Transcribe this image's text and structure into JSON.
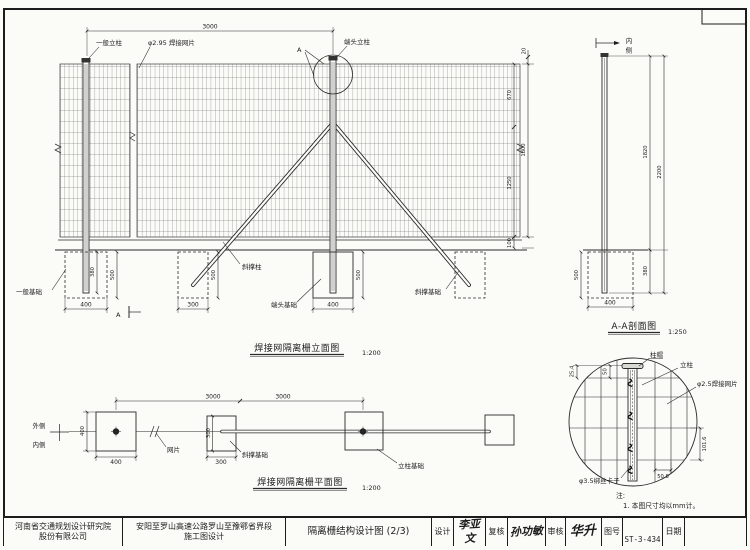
{
  "meta": {
    "paper_color": "#fbfbf8",
    "ink_color": "#1c1c1c"
  },
  "elevation": {
    "title": "焊接网隔离栅立面图",
    "scale": "1:200",
    "span_dim": "3000",
    "general_post_label": "一般立柱",
    "mesh_label": "φ2.95 焊接网片",
    "detail_ref": "A",
    "end_post_label": "端头立柱",
    "brace_post_label": "斜撑柱",
    "general_foundation_label": "一般基础",
    "end_foundation_label": "端头基础",
    "brace_foundation_label": "斜撑基础",
    "section_mark": "A",
    "dims": {
      "cap": "20",
      "upper": "670",
      "total": "1800",
      "lower": "1250",
      "ground_gap": "100",
      "post_embed": "380",
      "found_depth1": "500",
      "found_width1": "400",
      "brace_found_depth": "500",
      "brace_found_width": "300",
      "end_found_width": "400",
      "end_found_depth": "500"
    }
  },
  "section_aa": {
    "title": "A-A剖面图",
    "scale": "1:250",
    "inner_chars": [
      "内",
      "侧"
    ],
    "dims": {
      "above_ground": "1820",
      "total": "2200",
      "embed": "380",
      "found_depth": "500",
      "found_width": "400"
    }
  },
  "plan": {
    "title": "焊接网隔离栅平面图",
    "scale": "1:200",
    "outer_label": "外侧",
    "inner_label": "内侧",
    "mesh_label": "网片",
    "brace_foundation_label": "斜撑基础",
    "post_foundation_label": "立柱基础",
    "dims": {
      "found_h": "400",
      "found_w": "400",
      "span1": "3000",
      "span2": "3000",
      "brace_h": "300",
      "brace_w": "300"
    }
  },
  "detail": {
    "cap_label": "柱帽",
    "post_label": "立柱",
    "mesh_label": "φ2.5焊接网片",
    "clamp_label": "φ3.5绑丝卡子",
    "dims": {
      "cap_offset": "50",
      "wire_top": "25.4",
      "wire_v": "101.6",
      "wire_h": "50.8"
    }
  },
  "notes": {
    "title": "注:",
    "item1": "1. 本图尺寸均以mm计。"
  },
  "titleblock": {
    "company_line1": "河南省交通规划设计研究院",
    "company_line2": "股份有限公司",
    "project_line1": "安阳至罗山高速公路罗山至豫鄂省界段",
    "project_line2": "施工图设计",
    "drawing_title": "隔离栅结构设计图 (2/3)",
    "design_label": "设计",
    "design_sig": "李亚文",
    "check_label": "复核",
    "check_sig": "孙功敏",
    "review_label": "审核",
    "review_sig": "华升",
    "no_label": "图号",
    "no_value": "ST-3-434",
    "date_label": "日期",
    "date_value": ""
  }
}
